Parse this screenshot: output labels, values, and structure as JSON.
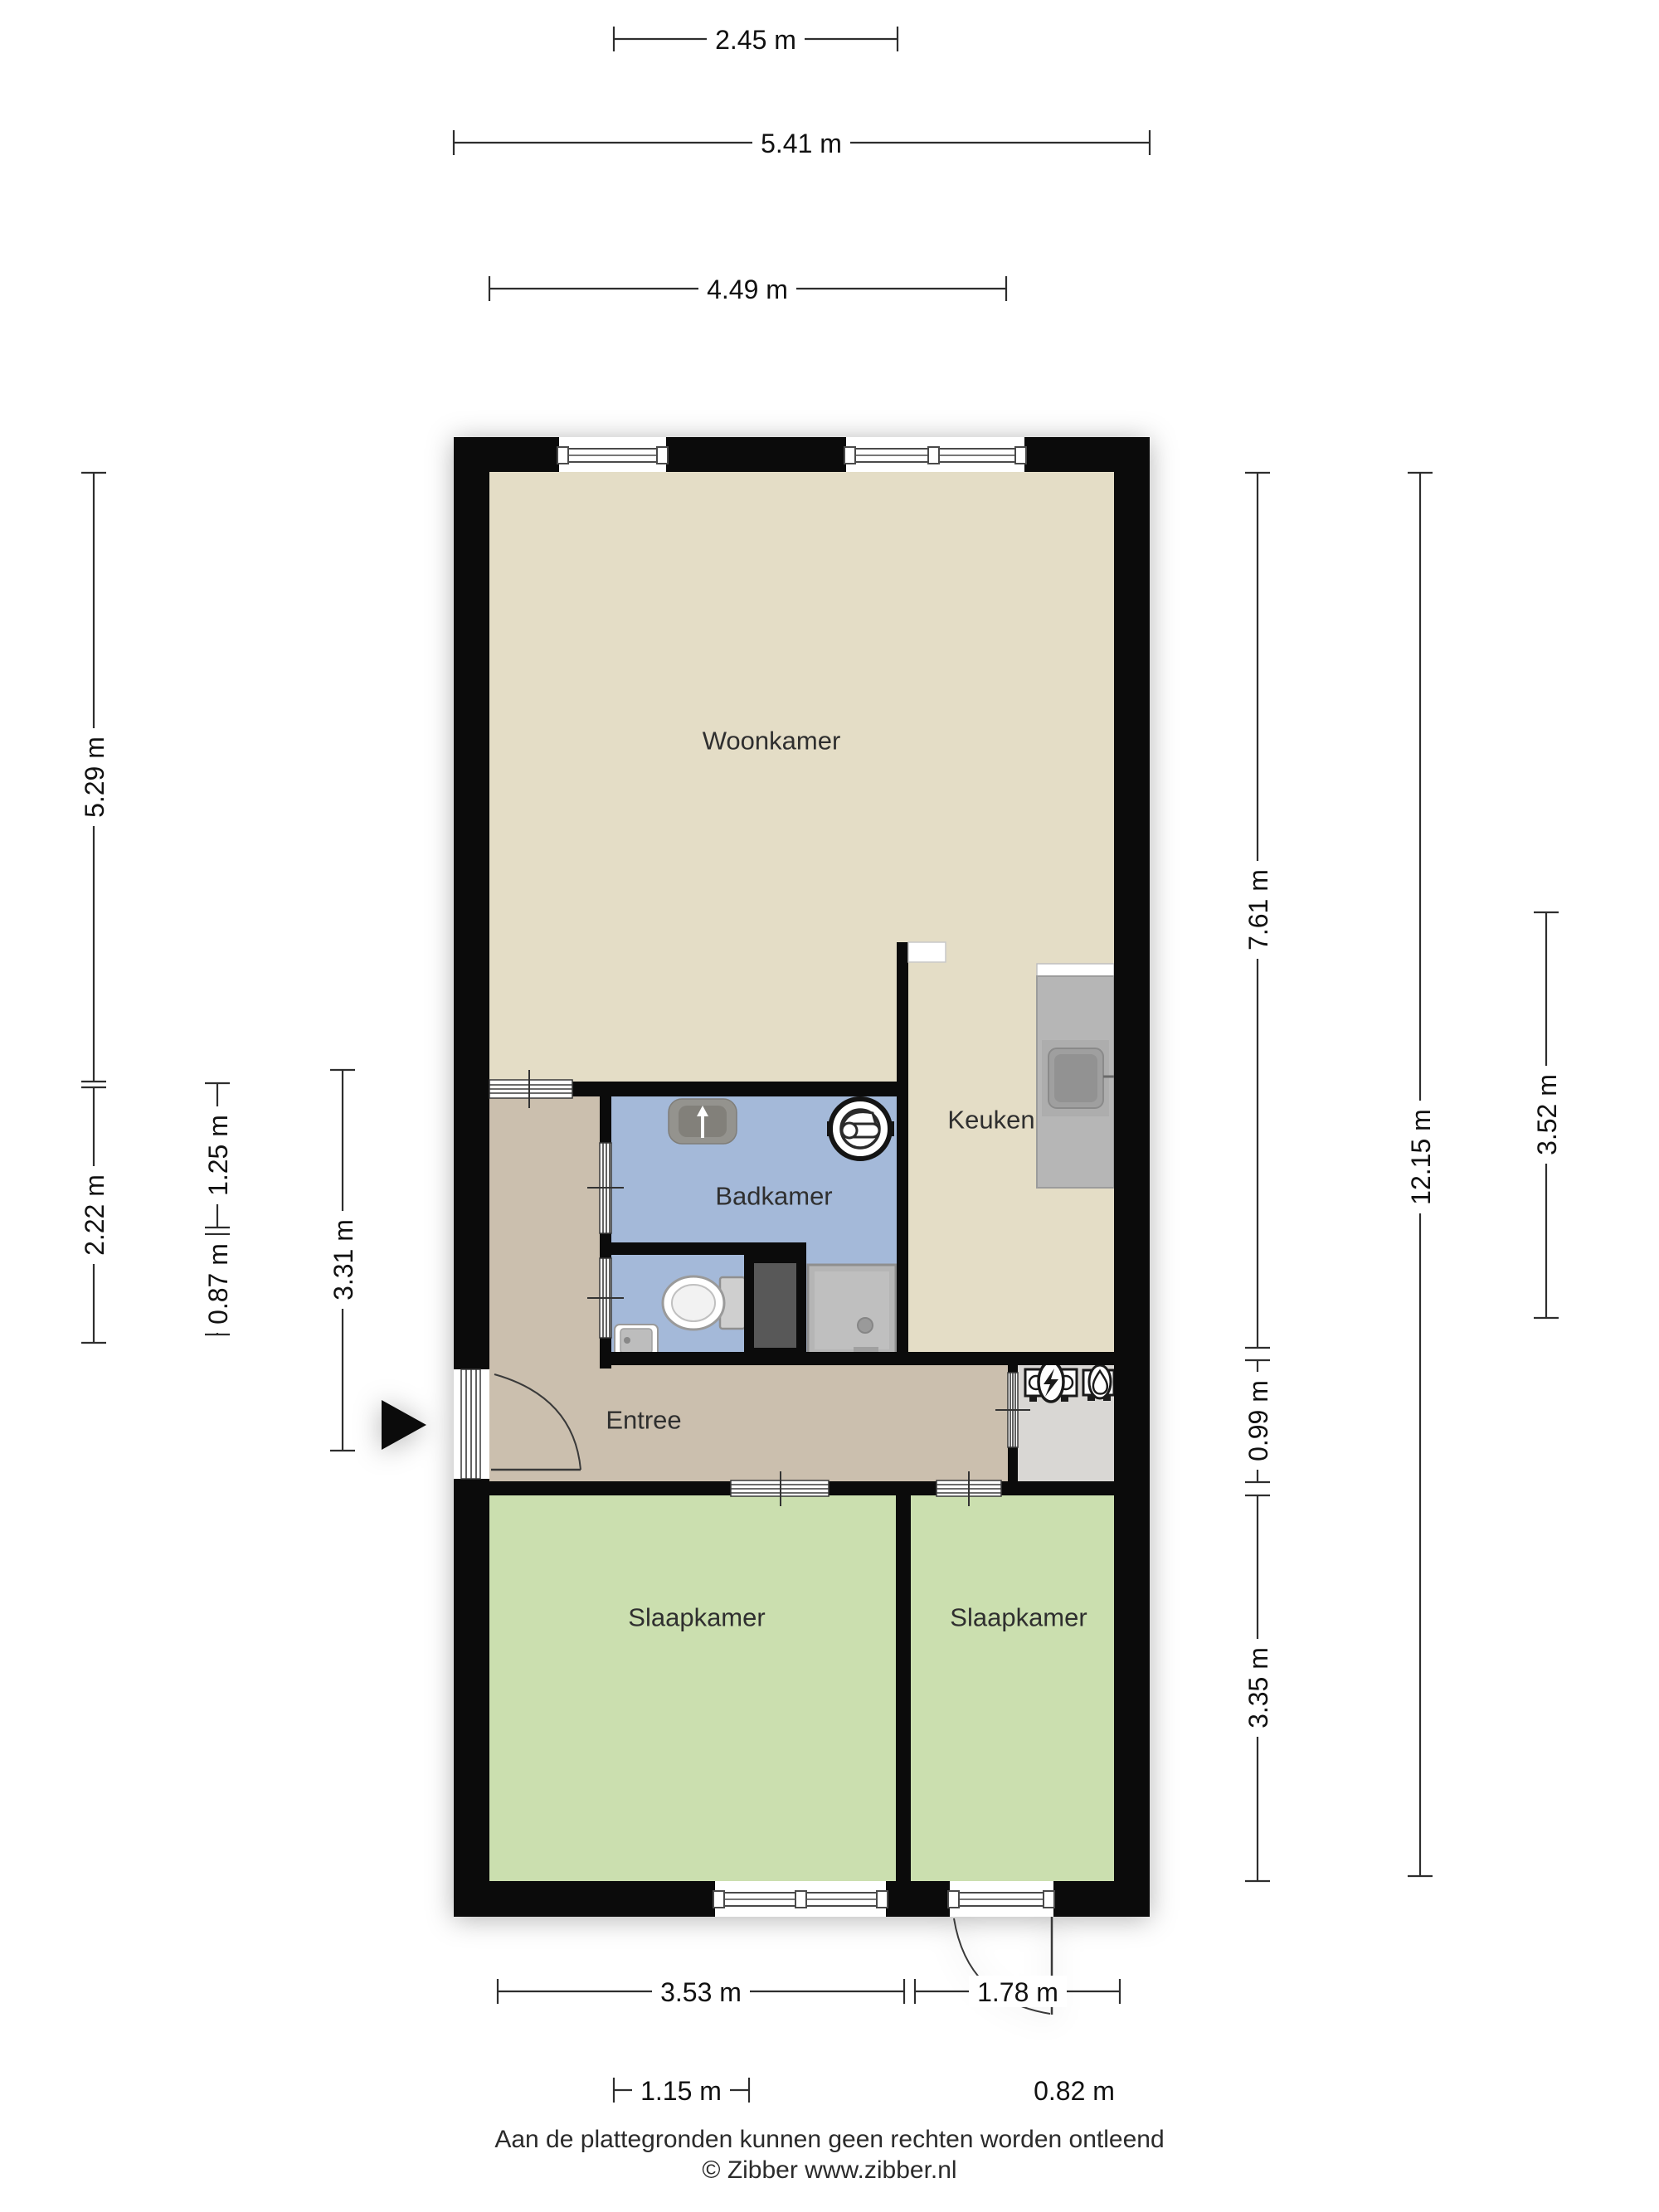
{
  "plan": {
    "type": "floor-plan",
    "language": "nl"
  },
  "rooms": [
    {
      "id": "woonkamer",
      "label": "Woonkamer"
    },
    {
      "id": "keuken",
      "label": "Keuken"
    },
    {
      "id": "badkamer",
      "label": "Badkamer"
    },
    {
      "id": "entree",
      "label": "Entree"
    },
    {
      "id": "slaapkamer-links",
      "label": "Slaapkamer"
    },
    {
      "id": "slaapkamer-rechts",
      "label": "Slaapkamer"
    }
  ],
  "dimensions": {
    "top": [
      {
        "value": "2.45 m"
      },
      {
        "value": "5.41 m"
      },
      {
        "value": "4.49 m"
      }
    ],
    "left": [
      {
        "value": "5.29 m"
      },
      {
        "value": "2.22 m"
      },
      {
        "value": "1.25 m"
      },
      {
        "value": "0.87 m"
      },
      {
        "value": "3.31 m"
      }
    ],
    "right": [
      {
        "value": "7.61 m"
      },
      {
        "value": "0.99 m"
      },
      {
        "value": "3.35 m"
      },
      {
        "value": "12.15 m"
      },
      {
        "value": "3.52 m"
      }
    ],
    "bottom": [
      {
        "value": "3.53 m"
      },
      {
        "value": "1.78 m"
      },
      {
        "value": "1.15 m"
      },
      {
        "value": "0.82 m"
      }
    ]
  },
  "footer": {
    "disclaimer": "Aan de plattegronden kunnen geen rechten worden ontleend",
    "copyright": "© Zibber www.zibber.nl"
  },
  "colors": {
    "walls": "#0b0b0b",
    "woonkamer_floor": "#e4ddc6",
    "keuken_floor": "#e4ddc6",
    "badkamer_floor": "#a4b9d9",
    "entree_floor": "#cbbfae",
    "slaapkamer_floor": "#cbdfaf",
    "meterkast_floor": "#d9d7d4",
    "counter": "#b6b6b6",
    "shaft": "#585858"
  },
  "fixtures": [
    "washing-machine",
    "bathroom-sink",
    "toilet",
    "wc-sink",
    "shower",
    "kitchen-counter",
    "kitchen-sink",
    "electric-meter",
    "gas-meter",
    "entrance-arrow"
  ]
}
